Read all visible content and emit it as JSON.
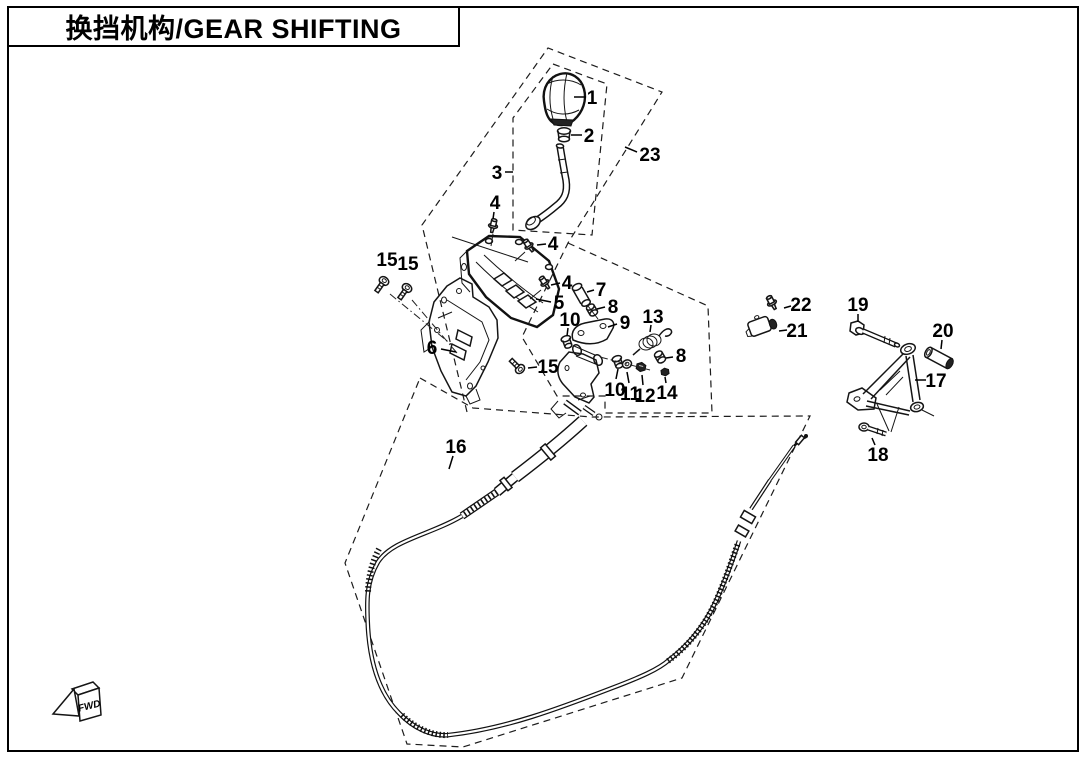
{
  "page": {
    "title": "换挡机构/GEAR SHIFTING",
    "fwd_label": "FWD"
  },
  "callouts": [
    {
      "num": "1"
    },
    {
      "num": "2"
    },
    {
      "num": "3"
    },
    {
      "num": "23"
    },
    {
      "num": "4"
    },
    {
      "num": "4"
    },
    {
      "num": "4"
    },
    {
      "num": "5"
    },
    {
      "num": "6"
    },
    {
      "num": "7"
    },
    {
      "num": "8"
    },
    {
      "num": "9"
    },
    {
      "num": "10"
    },
    {
      "num": "13"
    },
    {
      "num": "10"
    },
    {
      "num": "11"
    },
    {
      "num": "12"
    },
    {
      "num": "8"
    },
    {
      "num": "14"
    },
    {
      "num": "15"
    },
    {
      "num": "15"
    },
    {
      "num": "15"
    },
    {
      "num": "16"
    },
    {
      "num": "17"
    },
    {
      "num": "18"
    },
    {
      "num": "19"
    },
    {
      "num": "20"
    },
    {
      "num": "21"
    },
    {
      "num": "22"
    }
  ]
}
